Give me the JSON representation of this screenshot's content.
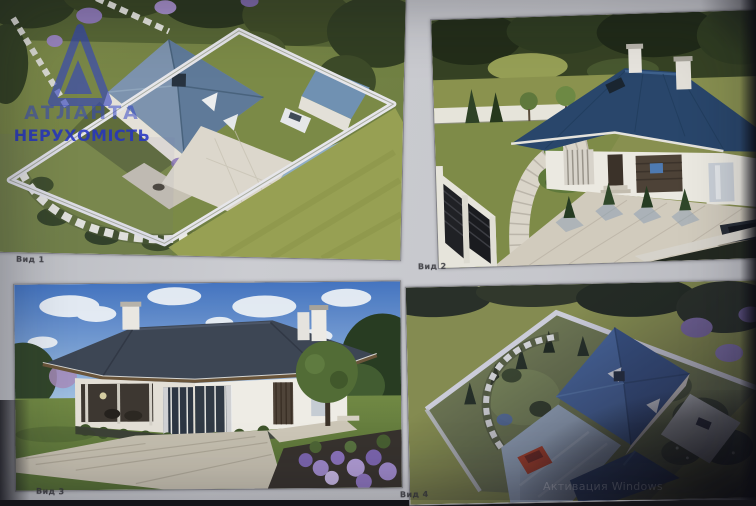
{
  "views": [
    {
      "id": "view-1",
      "label": "Вид 1"
    },
    {
      "id": "view-2",
      "label": "Вид 2"
    },
    {
      "id": "view-3",
      "label": "Вид 3"
    },
    {
      "id": "view-4",
      "label": "Вид 4"
    }
  ],
  "watermark": {
    "brand_line1": "АТЛАНТА",
    "brand_line2": "НЕРУХОМІСТЬ",
    "logo": "atlanta-triangle-logo",
    "color": "#2638d2"
  },
  "system_overlay": {
    "activate_windows_text": "Активация Windows"
  },
  "palette": {
    "paper": "#c7c8cc",
    "roof_navy": "#24456e",
    "roof_slate": "#3a4454",
    "roof_steel_blue": "#7b94b2",
    "lawn_green": "#76883f",
    "lawn_olive": "#8d9849",
    "wall_white": "#efece4",
    "sky_blue": "#3f74c8",
    "car_red": "#b83a1c",
    "flower_purple": "#8b74bc"
  }
}
